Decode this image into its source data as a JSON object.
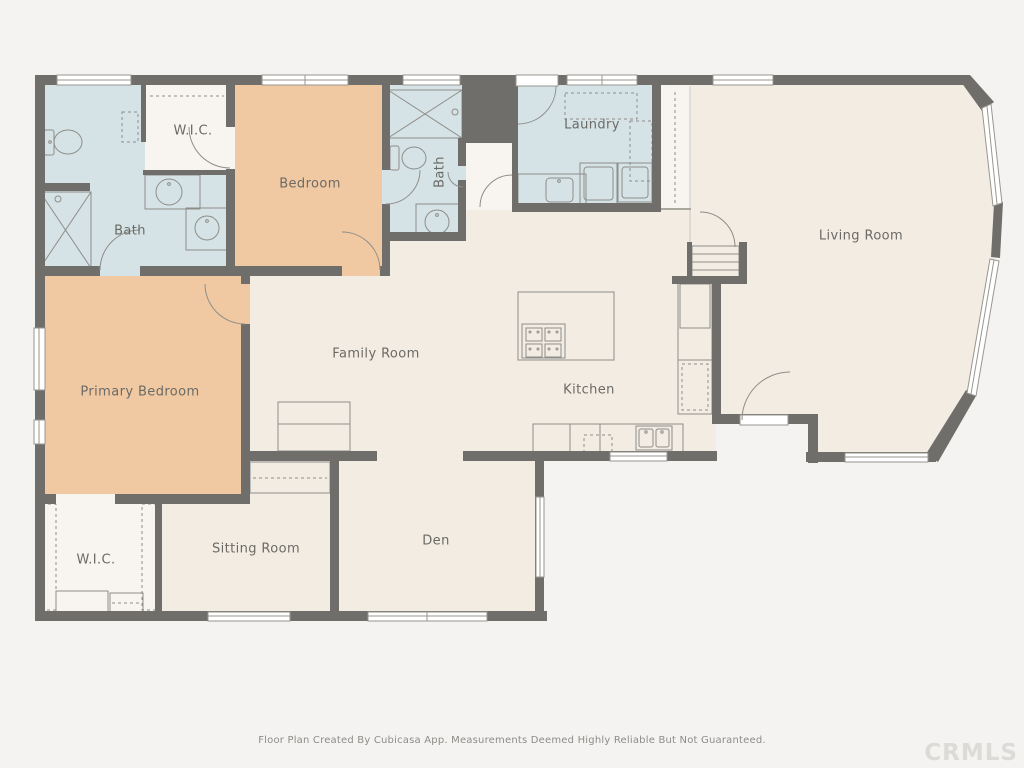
{
  "plan": {
    "creator_app": "Cubicasa",
    "rooms": [
      {
        "id": "bath-1",
        "label": "Bath",
        "type": "wet",
        "label_x": 130,
        "label_y": 231
      },
      {
        "id": "wic-1",
        "label": "W.I.C.",
        "type": "closet",
        "label_x": 193,
        "label_y": 131
      },
      {
        "id": "bedroom",
        "label": "Bedroom",
        "type": "bedroom",
        "label_x": 310,
        "label_y": 184
      },
      {
        "id": "bath-2",
        "label": "Bath",
        "type": "wet",
        "label_x": 440,
        "label_y": 172,
        "rotated": true
      },
      {
        "id": "laundry",
        "label": "Laundry",
        "type": "wet",
        "label_x": 592,
        "label_y": 125
      },
      {
        "id": "living-room",
        "label": "Living Room",
        "type": "living",
        "label_x": 861,
        "label_y": 236
      },
      {
        "id": "family-room",
        "label": "Family Room",
        "type": "living",
        "label_x": 376,
        "label_y": 354
      },
      {
        "id": "kitchen",
        "label": "Kitchen",
        "type": "living",
        "label_x": 589,
        "label_y": 390
      },
      {
        "id": "primary-bedroom",
        "label": "Primary Bedroom",
        "type": "bedroom",
        "label_x": 140,
        "label_y": 392
      },
      {
        "id": "wic-2",
        "label": "W.I.C.",
        "type": "closet",
        "label_x": 96,
        "label_y": 560
      },
      {
        "id": "sitting-room",
        "label": "Sitting Room",
        "type": "living",
        "label_x": 256,
        "label_y": 549
      },
      {
        "id": "den",
        "label": "Den",
        "type": "living",
        "label_x": 436,
        "label_y": 541
      }
    ],
    "fixtures": [
      "toilet",
      "shower",
      "sink-round",
      "sink-double",
      "washer",
      "dryer",
      "cooktop-island",
      "refrigerator",
      "dishwasher",
      "closet-shelves"
    ],
    "colors": {
      "wall": "#6f6e6a",
      "floor": "#f2ece3",
      "wet_room": "#d5e3e6",
      "bedroom": "#f0c9a3",
      "closet_floor": "#f8f5f1",
      "fixture_line": "#8f8d88",
      "page_background": "#f5f3f1",
      "label_text": "#6b6a65"
    }
  },
  "footer": {
    "disclaimer": "Floor Plan Created By Cubicasa App. Measurements Deemed Highly Reliable But Not Guaranteed.",
    "watermark": "CRMLS"
  }
}
